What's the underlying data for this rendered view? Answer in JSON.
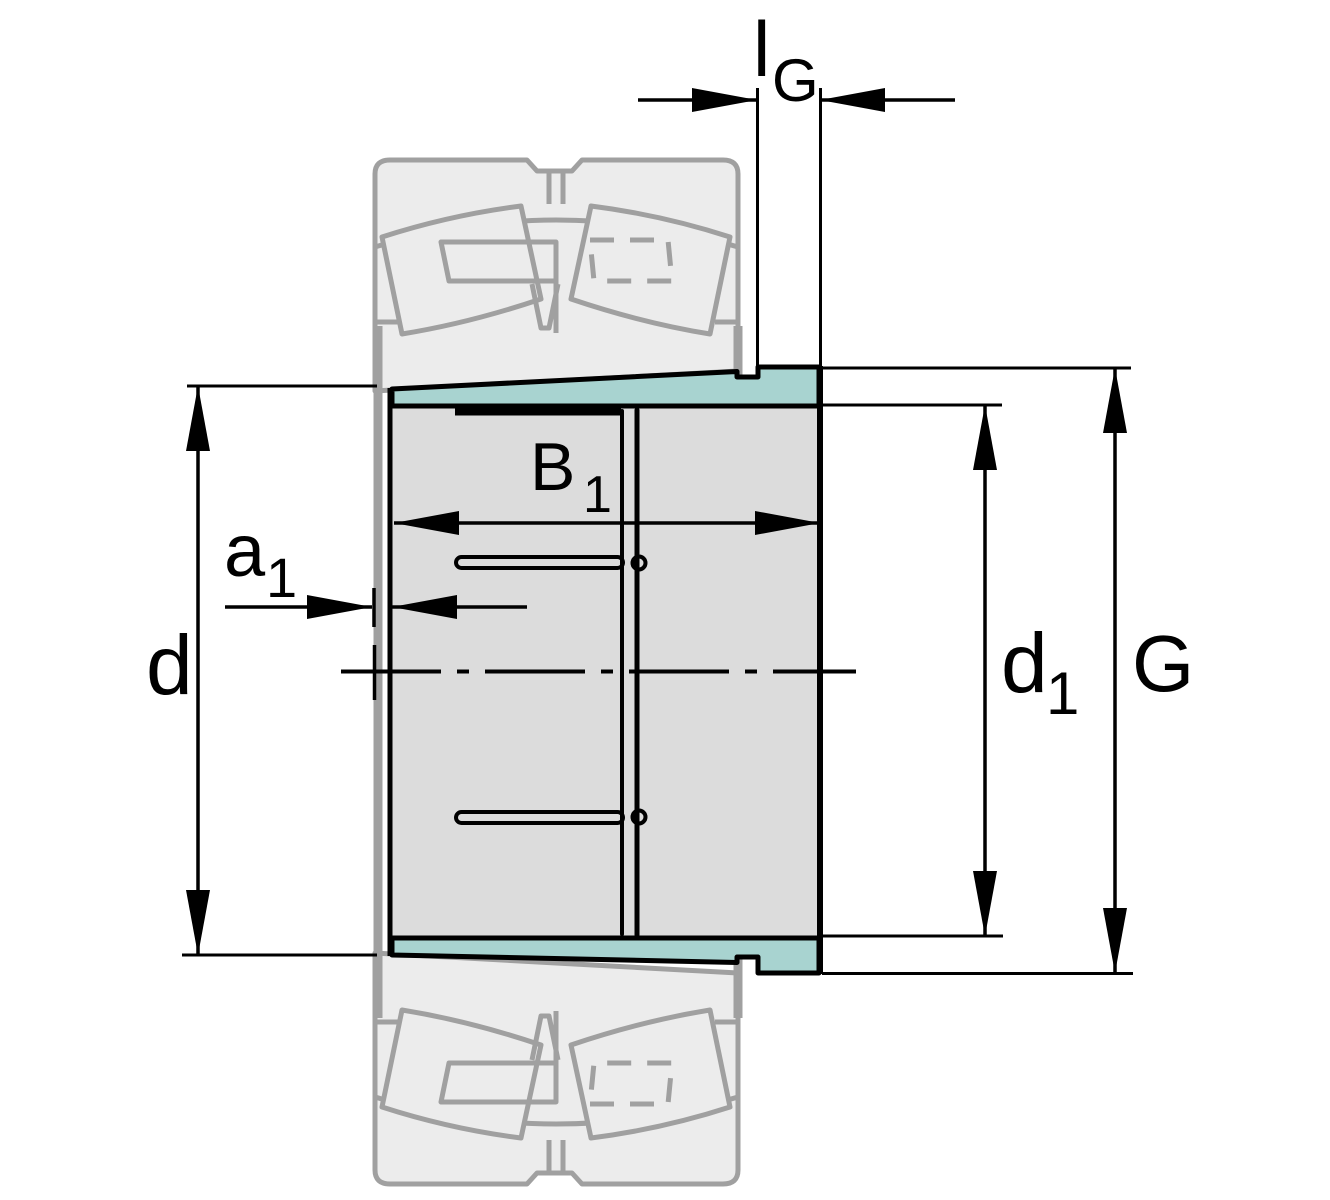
{
  "drawing": {
    "type": "engineering-cross-section",
    "subject": "adapter-sleeve-with-spherical-roller-bearing",
    "labels": {
      "lg_main": "l",
      "lg_sub": "G",
      "b1_main": "B",
      "b1_sub": "1",
      "a1_main": "a",
      "a1_sub": "1",
      "d_main": "d",
      "d1_main": "d",
      "d1_sub": "1",
      "g_main": "G"
    },
    "colors": {
      "highlight_teal": "#a8d3d0",
      "sleeve_grey": "#dcdcdc",
      "ghost_fill": "#ececec",
      "ghost_stroke": "#a0a0a0",
      "line_black": "#000000",
      "background": "#ffffff"
    }
  }
}
